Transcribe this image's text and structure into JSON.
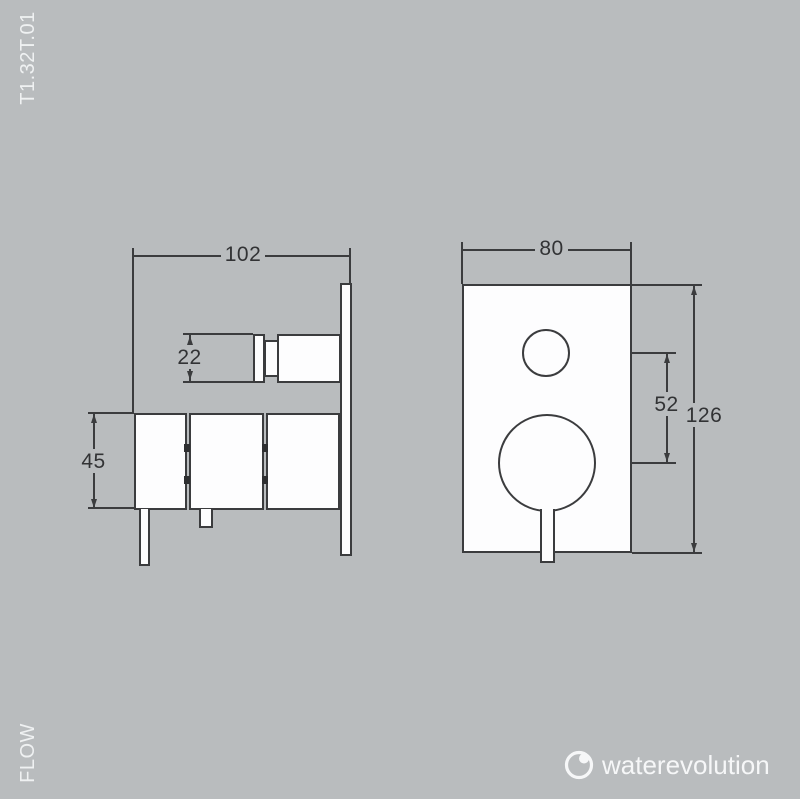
{
  "document": {
    "type": "technical-drawing",
    "product_code": "T1.32T.01",
    "flow_label": "FLOW"
  },
  "logo": {
    "brand": "waterevolution",
    "icon": "water-drop-circle-icon"
  },
  "views": {
    "side_view": {
      "title": "side view of concealed shower mixer",
      "width_mm": "102",
      "knob_height_mm": "22",
      "body_height_mm": "45"
    },
    "front_view": {
      "title": "front view of wall plate",
      "width_mm": "80",
      "center_distance_mm": "52",
      "height_mm": "126"
    }
  },
  "colors": {
    "background": "#b9bcbe",
    "line": "#3b3c3e",
    "shape_fill": "#fdfdfe",
    "light_text": "#eff1f2"
  }
}
